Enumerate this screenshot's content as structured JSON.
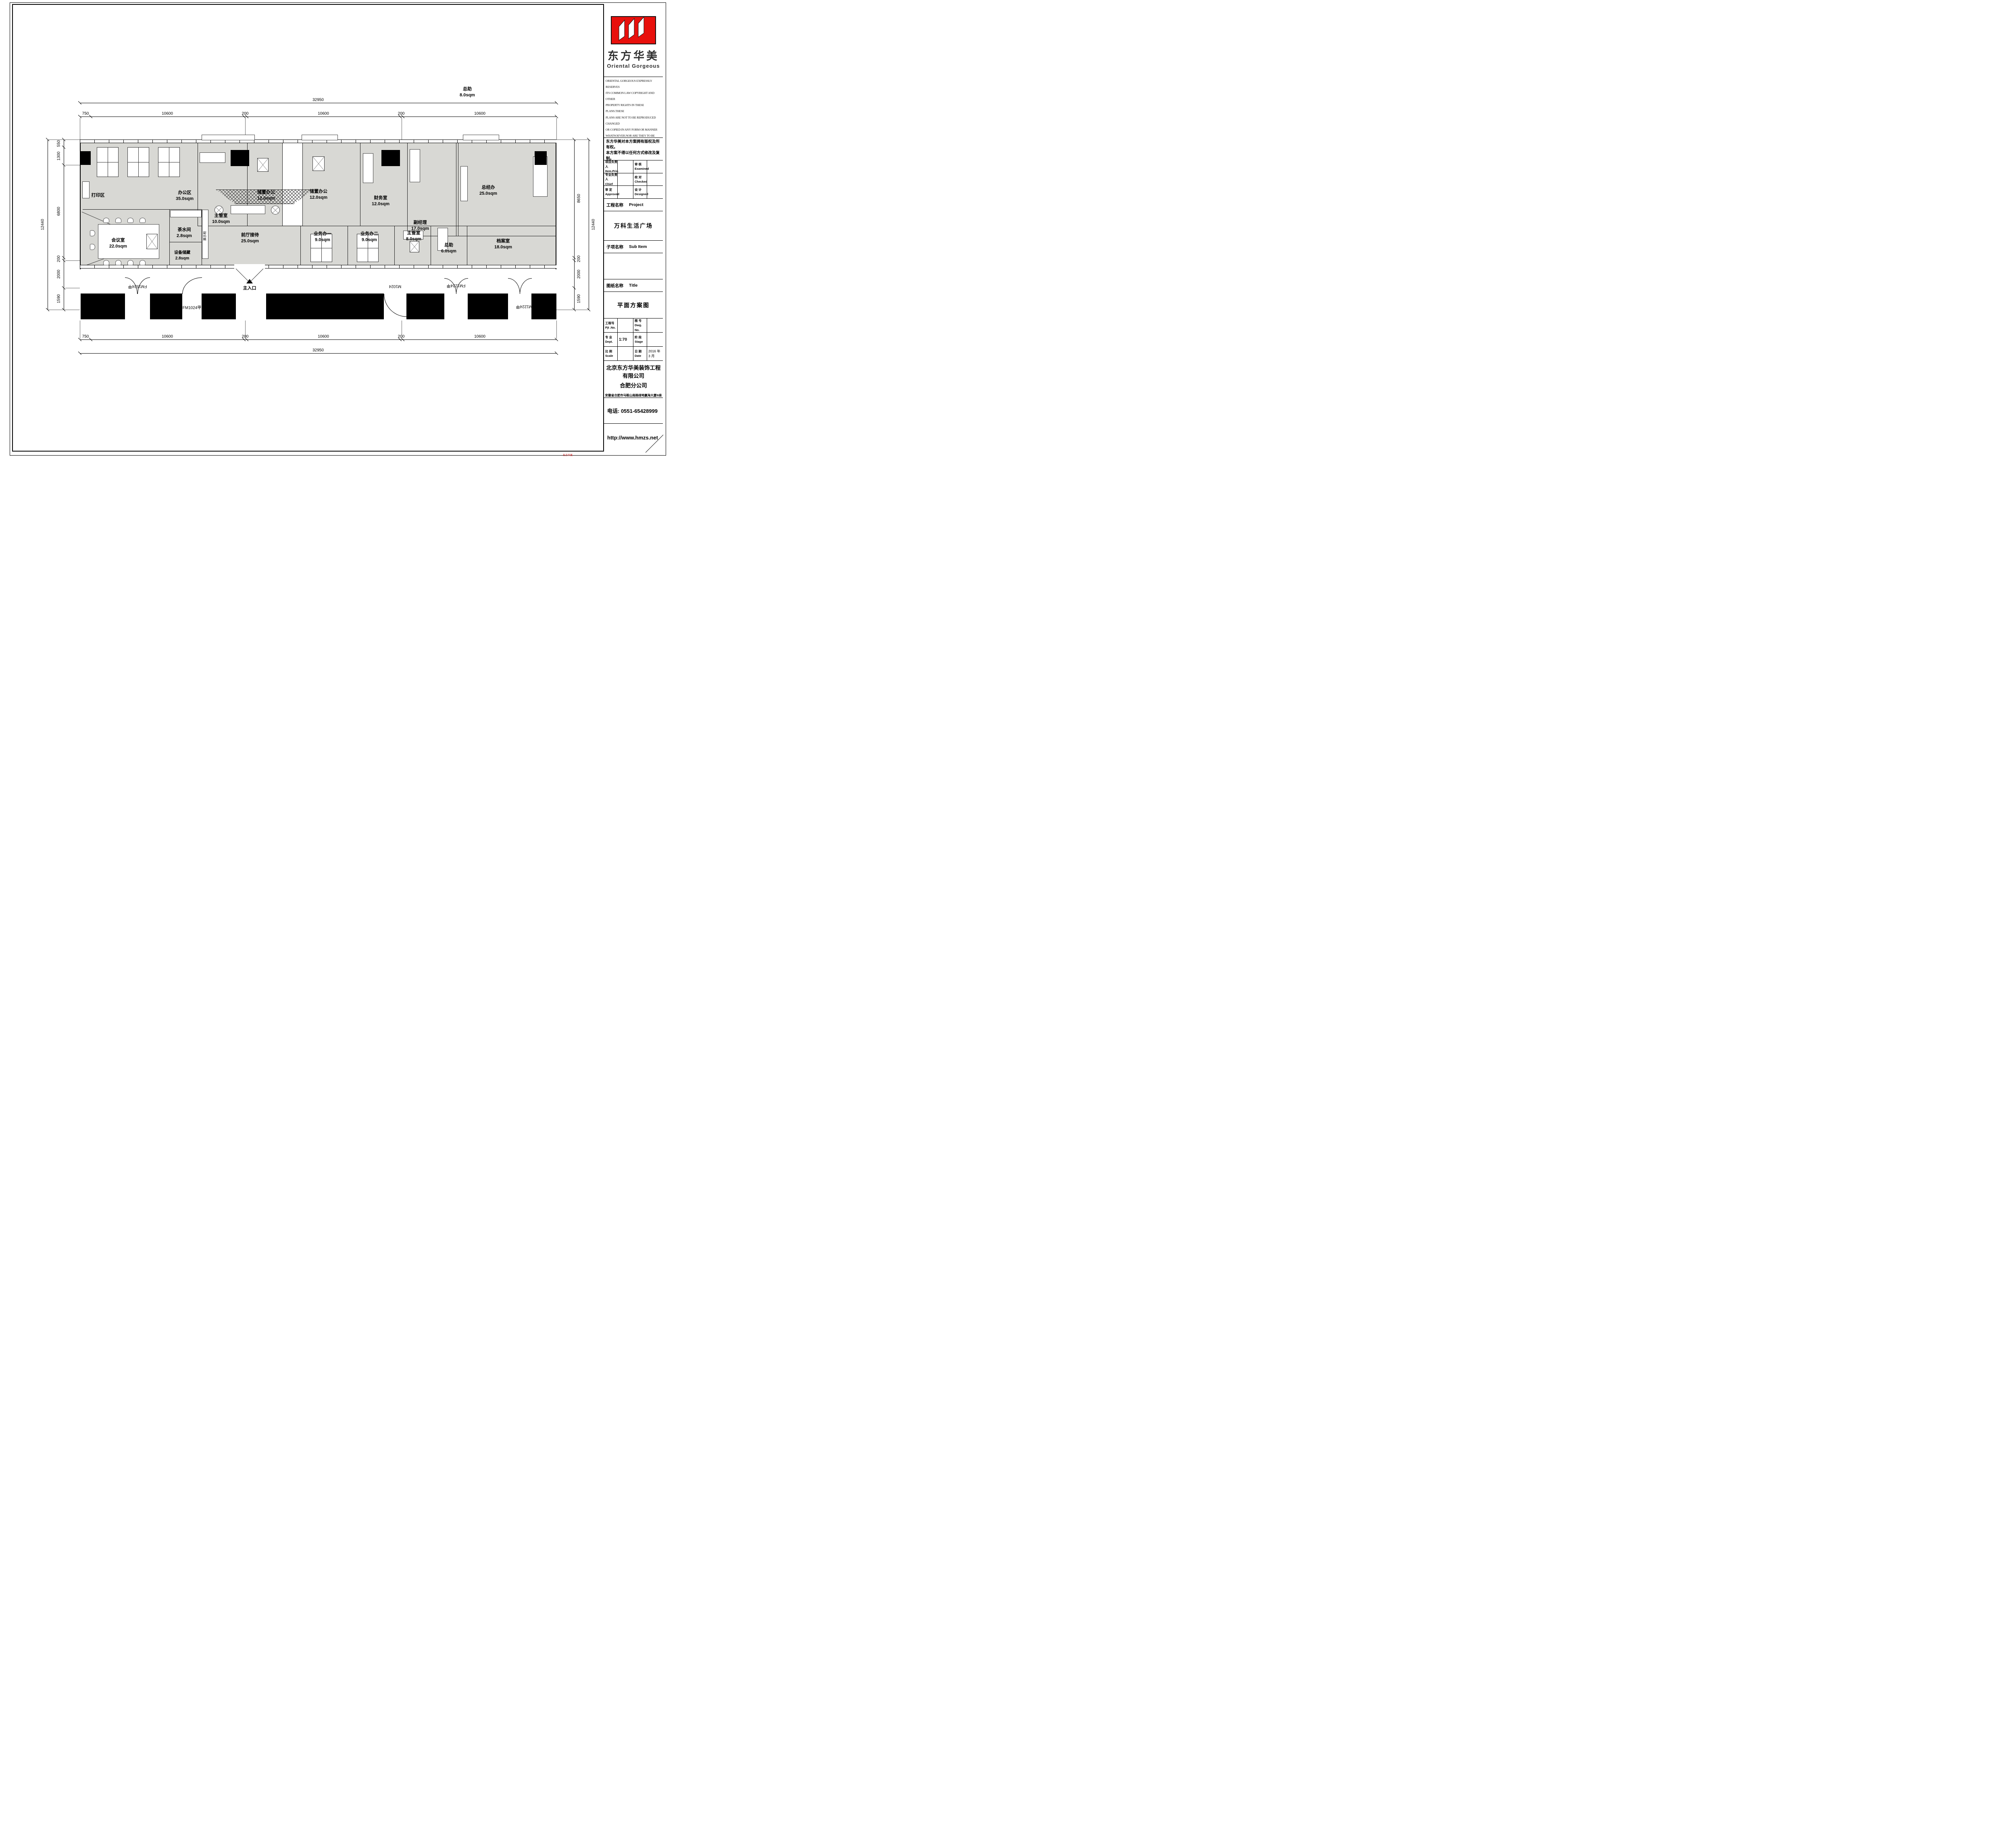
{
  "title_block": {
    "brand_cn": "东方华美",
    "brand_en": "Oriental Gorgeous",
    "logo_color": "#e8100c",
    "copyright_en_lines": [
      "ORIENTAL GORGEOUS EXPRESSLY RESERVES",
      "ITS COMMON LAW COPYRIGHT AND OTHER",
      "PROPERTY RIGHTS IN THESE PLANS.THESE",
      "PLANS ARE NOT TO BE REPRODUCED CHANGED",
      "OR COPIED IN ANY FORM OR MANNER",
      "WHATSOEVER.NOR ARE THEY TO BE ASSIGHED",
      "TO ANY THIRD PARTY WITHOUT FIRST",
      "OBTAINING THE EXPRESSED WRITTEN",
      "PERMISSION AND CONSENT OF ORIENTAL",
      "GORGEOUS"
    ],
    "copyright_cn_lines": [
      "东方华美对本方案拥有版权及所有权。",
      "本方案不得以任何方式修改及复制。",
      "未经东方华美书面授权，本方案不得向",
      "任何第三方转让。"
    ],
    "personnel": [
      {
        "cn": "项目负责人",
        "en": "Item.Prin",
        "cn2": "审 核",
        "en2": "Examined"
      },
      {
        "cn": "专业负责人",
        "en": "Chief",
        "cn2": "校 对",
        "en2": "Checked"
      },
      {
        "cn": "审 定",
        "en": "Approved",
        "cn2": "设 计",
        "en2": "Designed"
      }
    ],
    "project_label_cn": "工程名称",
    "project_label_en": "Project",
    "project_name": "万科生活广场",
    "subitem_label_cn": "子项名称",
    "subitem_label_en": "Sub Item",
    "sheet_label_cn": "图纸名称",
    "sheet_label_en": "Title",
    "sheet_name": "平面方案图",
    "info_table": [
      {
        "cn": "工程号",
        "en": "Pjt .No.",
        "val": "",
        "cn2": "图 号",
        "en2": "Dwg. No.",
        "val2": ""
      },
      {
        "cn": "专 业",
        "en": "Dept.",
        "val": "1:70",
        "cn2": "阶 段",
        "en2": "Stage",
        "val2": ""
      },
      {
        "cn": "比 例",
        "en": "Scale",
        "val": "",
        "cn2": "日 期",
        "en2": "Date",
        "val2": "2016 年 3 月"
      }
    ],
    "company_line1": "北京东方华美装饰工程有限公司",
    "company_line2": "合肥分公司",
    "company_address": "安徽省合肥市马鞍山南路绿地赢海大厦B座19楼",
    "phone": "电话: 0551-65428999",
    "website": "http://www.hmzs.net",
    "watermark": "东方华美"
  },
  "plan": {
    "rooms": [
      {
        "name": "办公区",
        "area": "35.0sqm"
      },
      {
        "name": "打印区",
        "area": ""
      },
      {
        "name": "主管室",
        "area": "10.0sqm"
      },
      {
        "name": "储置办公",
        "area": "12.0sqm"
      },
      {
        "name": "储置办公",
        "area": "12.0sqm"
      },
      {
        "name": "财务室",
        "area": "12.0sqm"
      },
      {
        "name": "副经理",
        "area": "17.0sqm"
      },
      {
        "name": "总经办",
        "area": "25.0sqm"
      },
      {
        "name": "会议室",
        "area": "22.0sqm"
      },
      {
        "name": "茶水间",
        "area": "2.8sqm"
      },
      {
        "name": "设备储藏",
        "area": "2.8sqm"
      },
      {
        "name": "前厅接待",
        "area": "25.0sqm"
      },
      {
        "name": "业务办一",
        "area": "9.0sqm"
      },
      {
        "name": "业务办二",
        "area": "9.0sqm"
      },
      {
        "name": "主管室",
        "area": "8.0sqm"
      },
      {
        "name": "总助",
        "area": "6.0sqm"
      },
      {
        "name": "档案室",
        "area": "18.0sqm"
      },
      {
        "name": "总助",
        "area": "8.0sqm"
      }
    ],
    "doors": [
      "FM1524甲",
      "FM1024甲",
      "M1024",
      "FM1224甲",
      "FM1224甲"
    ],
    "entrance": "主入口",
    "cabinet_label": "展示柜"
  },
  "dimensions": {
    "top": {
      "total": "32950",
      "chain": [
        "750",
        "10600",
        "200",
        "10600",
        "200",
        "10600"
      ]
    },
    "bottom": {
      "total": "32950",
      "chain": [
        "750",
        "10600",
        "200",
        "10600",
        "200",
        "10600"
      ]
    },
    "left": {
      "total": "12440",
      "chain": [
        "550",
        "1300",
        "6800",
        "200",
        "2000",
        "1590"
      ]
    },
    "right": {
      "total": "12440",
      "chain": [
        "8650",
        "200",
        "2000",
        "1590"
      ]
    }
  }
}
